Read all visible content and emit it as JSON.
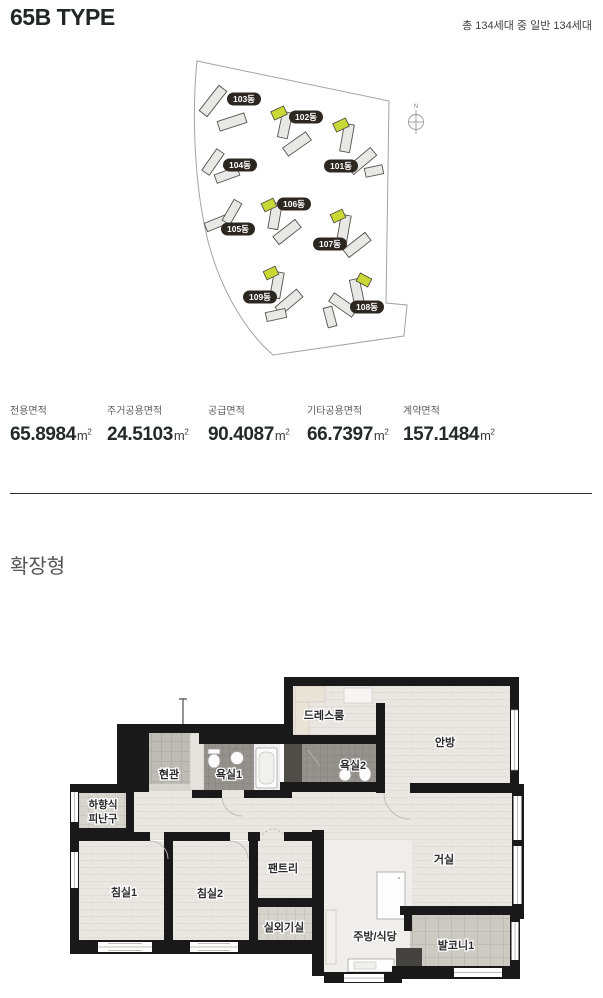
{
  "header": {
    "title": "65B TYPE",
    "note": "총 134세대 중 일반 134세대"
  },
  "sitemap": {
    "compass_label": "N",
    "buildings": [
      {
        "label": "103동",
        "highlighted": false
      },
      {
        "label": "102동",
        "highlighted": true
      },
      {
        "label": "104동",
        "highlighted": false
      },
      {
        "label": "101동",
        "highlighted": true
      },
      {
        "label": "106동",
        "highlighted": true
      },
      {
        "label": "105동",
        "highlighted": false
      },
      {
        "label": "107동",
        "highlighted": true
      },
      {
        "label": "109동",
        "highlighted": true
      },
      {
        "label": "108동",
        "highlighted": true
      }
    ],
    "colors": {
      "highlight": "#c8d935",
      "building": "#e8e8e6",
      "label_bg": "#2d2722"
    }
  },
  "stats": {
    "unit_base": "m",
    "unit_exp": "2",
    "items": [
      {
        "label": "전용면적",
        "value": "65.8984"
      },
      {
        "label": "주거공용면적",
        "value": "24.5103"
      },
      {
        "label": "공급면적",
        "value": "90.4087"
      },
      {
        "label": "기타공용면적",
        "value": "66.7397"
      },
      {
        "label": "계약면적",
        "value": "157.1484"
      }
    ]
  },
  "section": {
    "heading": "확장형"
  },
  "floorplan": {
    "rooms": [
      {
        "label": "드레스룸"
      },
      {
        "label": "안방"
      },
      {
        "label": "현관"
      },
      {
        "label": "욕실1"
      },
      {
        "label": "욕실2"
      },
      {
        "label": "하향식 피난구",
        "line1": "하향식",
        "line2": "피난구"
      },
      {
        "label": "침실1"
      },
      {
        "label": "침실2"
      },
      {
        "label": "팬트리"
      },
      {
        "label": "거실"
      },
      {
        "label": "실외기실"
      },
      {
        "label": "주방/식당"
      },
      {
        "label": "발코니1"
      }
    ],
    "wall_color": "#191919"
  }
}
